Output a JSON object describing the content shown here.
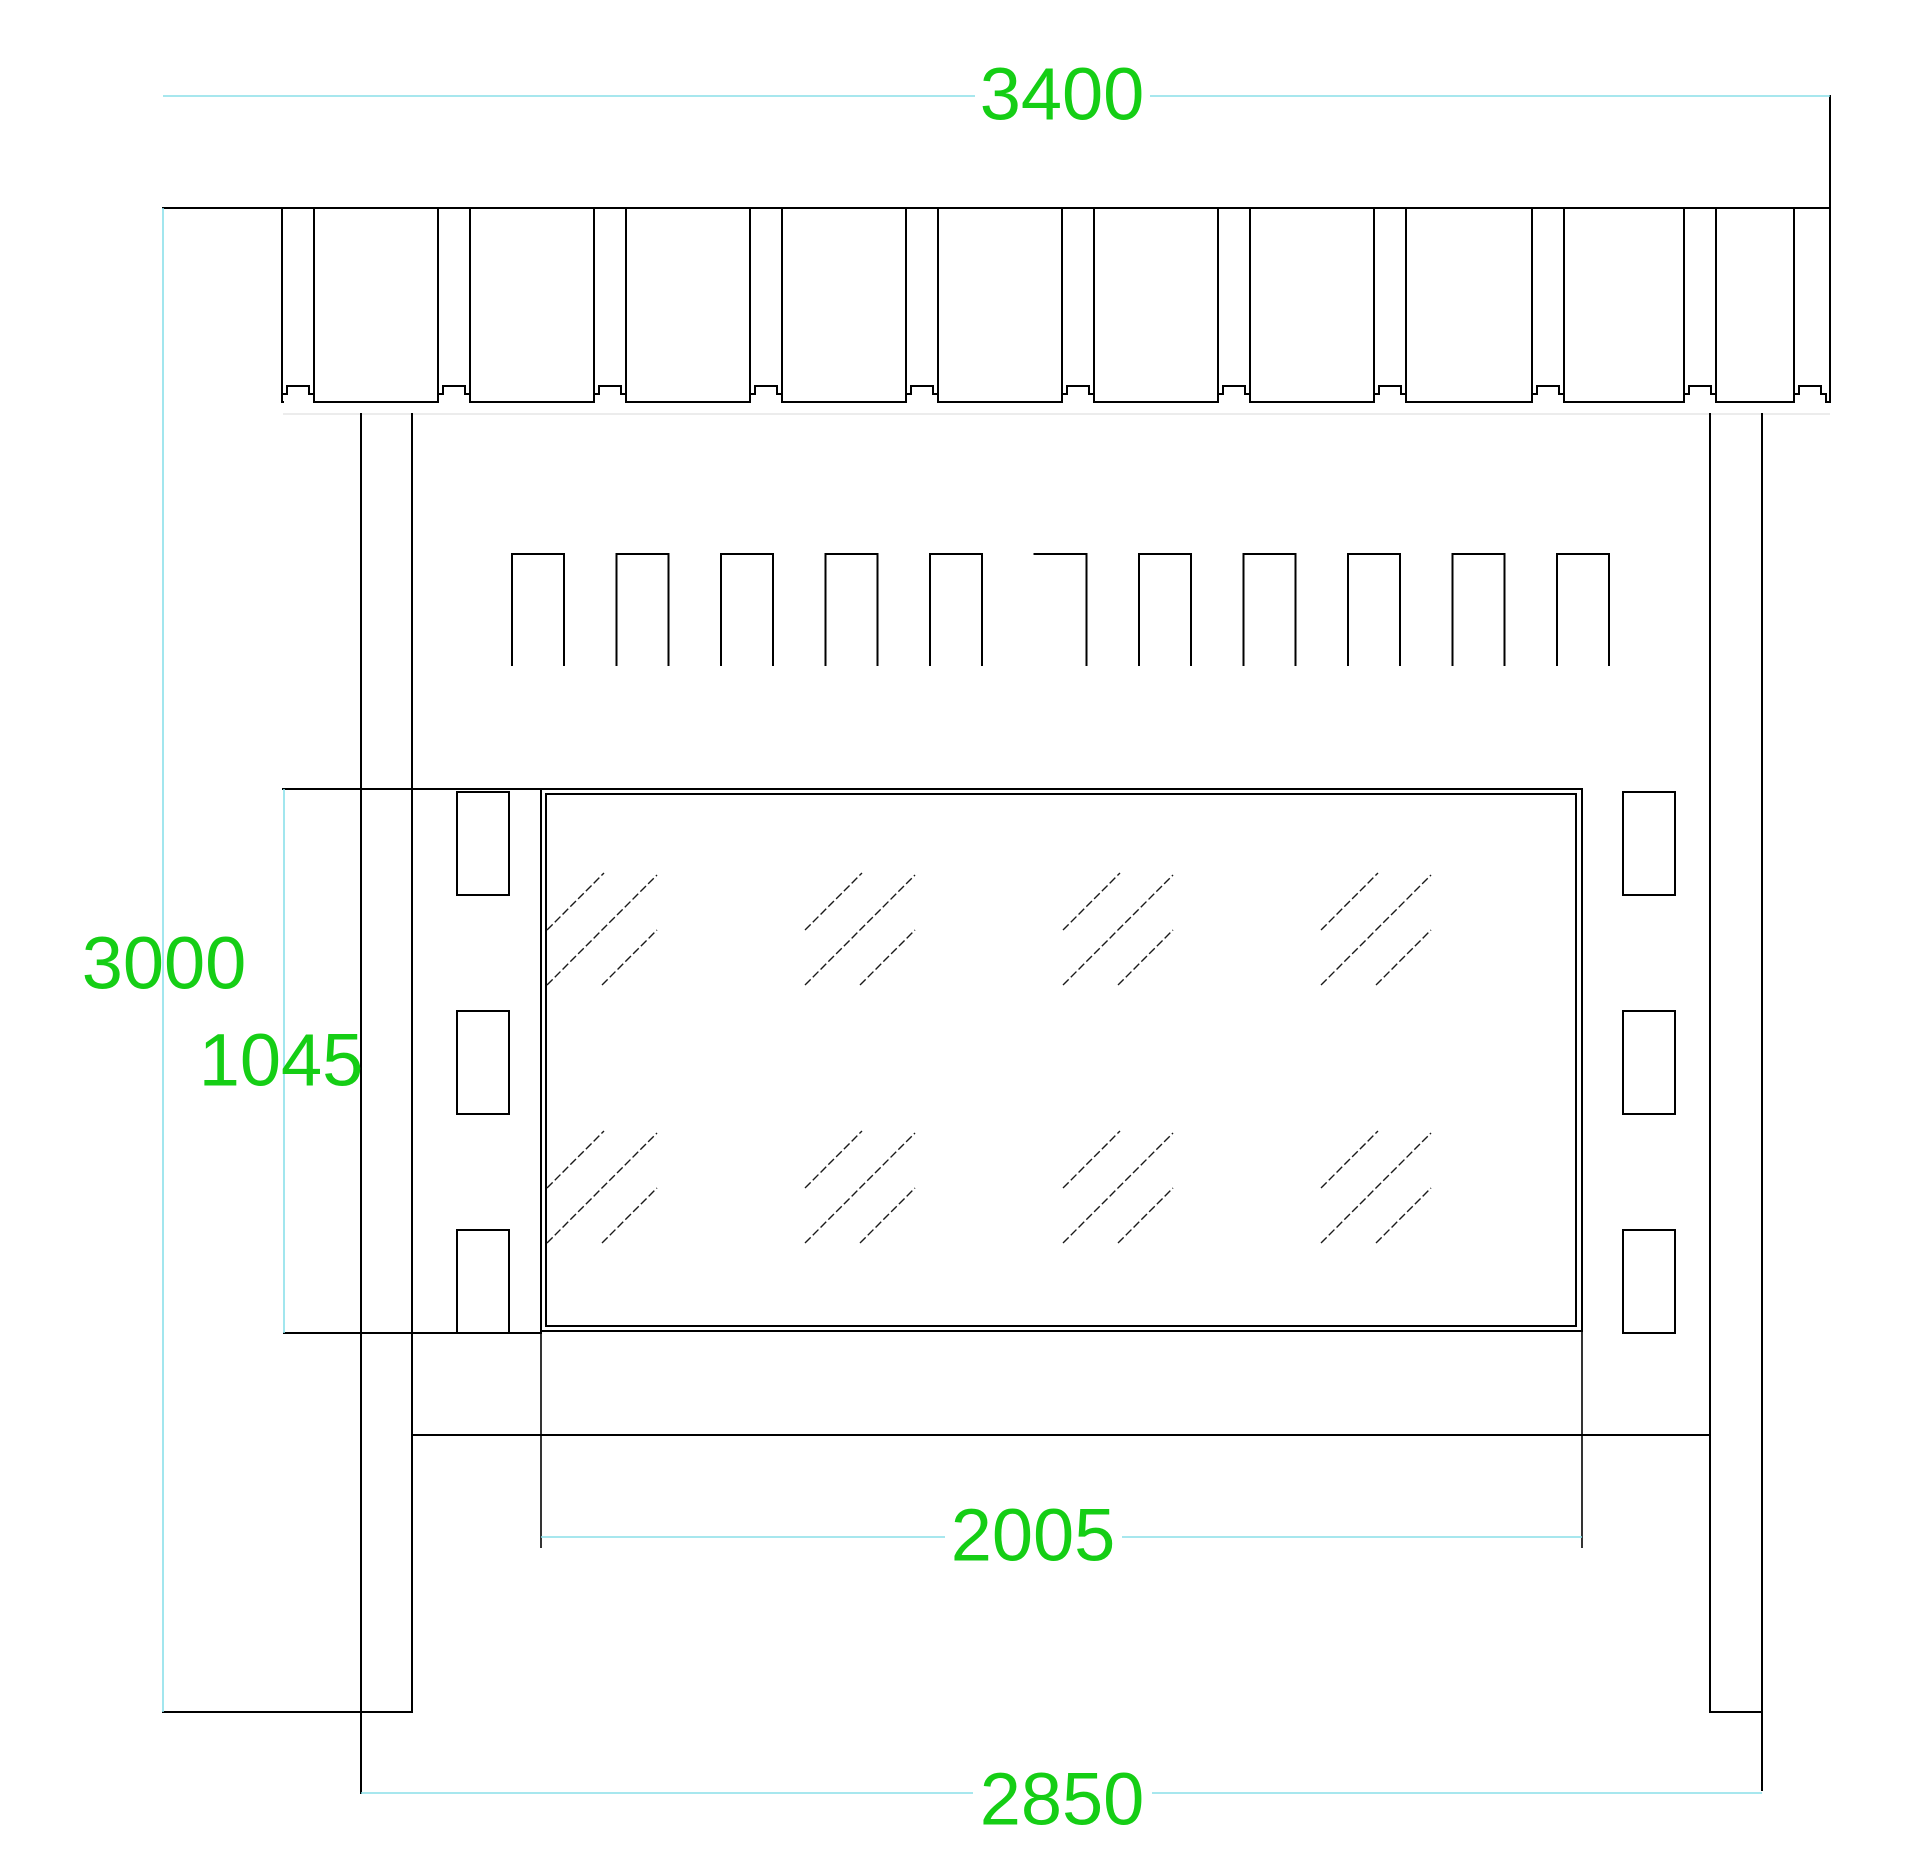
{
  "title": "storefront-elevation-cad-drawing",
  "colors": {
    "background": "#ffffff",
    "line": "#000000",
    "dimension_line": "#8adfe9",
    "dimension_text": "#15ce15",
    "faint_line": "#dadada"
  },
  "dimensions": {
    "overall_width": {
      "label": "3400",
      "orientation": "horizontal",
      "location": "top"
    },
    "overall_height": {
      "label": "3000",
      "orientation": "vertical",
      "location": "left"
    },
    "panel_height": {
      "label": "1045",
      "orientation": "vertical",
      "location": "left"
    },
    "glass_width": {
      "label": "2005",
      "orientation": "horizontal",
      "location": "bottom"
    },
    "base_span": {
      "label": "2850",
      "orientation": "horizontal",
      "location": "bottom"
    }
  },
  "geometry": {
    "canvas": {
      "width": 1920,
      "height": 1873
    },
    "top_rail": {
      "left": 163,
      "right": 1830,
      "top": 208,
      "baseline": 402,
      "baseline_start": 283,
      "shadow_y": 414,
      "bump_centers": [
        298,
        454,
        610,
        766,
        922,
        1078,
        1234,
        1390,
        1548,
        1700,
        1810
      ],
      "bump_half": 16,
      "bump_inner_half": 11,
      "bump_step_y": 394,
      "bump_top_y": 386,
      "right_edge_top": 96
    },
    "posts": {
      "plate_y": 1712,
      "left": {
        "x1": 361,
        "x2": 412,
        "top": 414,
        "x1_bottom": 1793,
        "x2_bottom": 1712,
        "plate": [
          163,
          412
        ]
      },
      "right": {
        "x1": 1710,
        "x2": 1762,
        "top": 414,
        "x1_bottom": 1712,
        "x2_bottom": 1790,
        "plate": [
          1710,
          1762
        ]
      }
    },
    "battens": {
      "count": 11,
      "start_x": 512,
      "pitch": 104.5,
      "width": 52,
      "top": 554,
      "bottom": 665,
      "missing_left_side_index": 5
    },
    "frame": {
      "shelf_y": 789,
      "shelf_x1": 283,
      "shelf_x2": 1582,
      "outer": [
        541,
        789,
        1582,
        1331
      ],
      "inner": [
        546,
        794,
        1576,
        1326
      ],
      "side_rect_width": 52,
      "side_rect_height": 103,
      "side_rect_tops": [
        792,
        1011,
        1230
      ],
      "left_rect_x": 457,
      "right_rect_x": 1623,
      "ext_y": 1333,
      "ext_x1": 284,
      "ext_x2": 541,
      "rail_y": 1435,
      "rail_x1": 412,
      "rail_x2": 1710
    },
    "hatch": {
      "cols": [
        547,
        805,
        1063,
        1321
      ],
      "rows": [
        873,
        1131
      ],
      "lines": [
        [
          0,
          57,
          57,
          0
        ],
        [
          0,
          112,
          110,
          2
        ],
        [
          55,
          112,
          110,
          57
        ]
      ]
    },
    "dims": {
      "d3400": {
        "y": 96,
        "x1": 163,
        "x2": 1830,
        "gap": [
          975,
          1150
        ]
      },
      "d3000": {
        "x": 163,
        "y1": 208,
        "y2": 1712
      },
      "d1045": {
        "x": 284,
        "y1": 789,
        "y2": 1333
      },
      "d2005": {
        "y": 1537,
        "x1": 541,
        "x2": 1582,
        "gap": [
          945,
          1122
        ],
        "ext": [
          [
            541,
            1331,
            1548
          ],
          [
            1582,
            1331,
            1548
          ]
        ]
      },
      "d2850": {
        "y": 1793,
        "x1": 361,
        "x2": 1762,
        "gap": [
          973,
          1152
        ]
      }
    }
  }
}
